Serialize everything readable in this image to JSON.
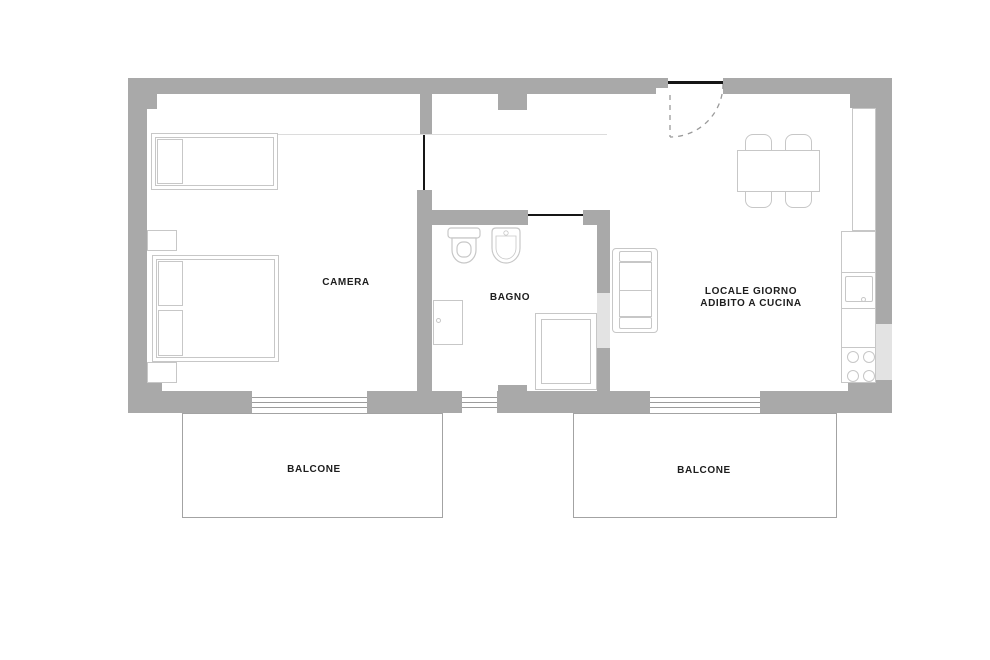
{
  "plan": {
    "type": "apartment-floor-plan",
    "colors": {
      "wall": "#a9a9a9",
      "wall_light": "#e3e3e3",
      "furniture_stroke": "#c7c7c7",
      "door_line": "#161616",
      "text": "#1d1d1d",
      "glazing_line": "#9c9c9c",
      "balcony_stroke": "#a3a3a3"
    },
    "rooms": {
      "camera": {
        "label": "CAMERA"
      },
      "bagno": {
        "label": "BAGNO"
      },
      "soggiorno": {
        "label_line1": "LOCALE GIORNO",
        "label_line2": "ADIBITO A CUCINA"
      },
      "balcone_left": {
        "label": "BALCONE"
      },
      "balcone_right": {
        "label": "BALCONE"
      }
    }
  }
}
